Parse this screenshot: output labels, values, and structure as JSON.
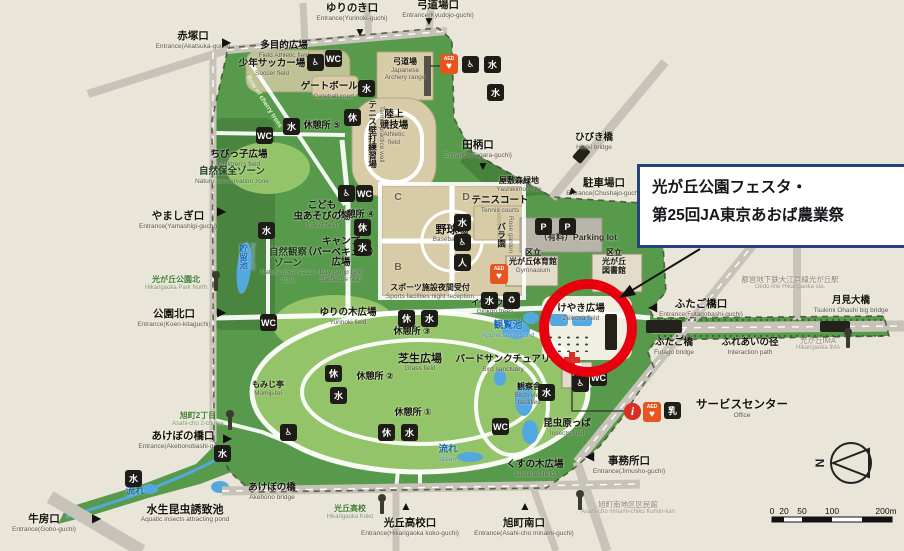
{
  "annotation": {
    "line1": "光が丘公園フェスタ・",
    "line2": "第25回JA東京あおば農業祭"
  },
  "compass": {
    "n": "N"
  },
  "scale": {
    "t0": "0",
    "t1": "20",
    "t2": "50",
    "t3": "100",
    "t4": "200m"
  },
  "colors": {
    "bg": "#eae5d9",
    "park": "#579a4b",
    "park_light": "#94c46a",
    "park_dark": "#47813c",
    "field": "#d8cca8",
    "road": "#c7c3b8",
    "water": "#54a8e0",
    "red": "#e8000f",
    "callout_border": "#26437e",
    "icon_bg": "#1d1c16",
    "aed": "#e8541e",
    "info": "#d93025"
  },
  "labels": [
    {
      "name": "entrance-akatsuka",
      "cls": "entrance",
      "x": 193,
      "y": 31,
      "jp": [
        "赤塚口"
      ],
      "en": [
        "Entrance(Akatsuka-guchi)"
      ]
    },
    {
      "name": "entrance-yurinoki",
      "cls": "entrance",
      "x": 352,
      "y": 3,
      "jp": [
        "ゆりのき口"
      ],
      "en": [
        "Entrance(Yurinoki-guchi)"
      ]
    },
    {
      "name": "entrance-kyudojo",
      "cls": "entrance",
      "x": 438,
      "y": 0,
      "jp": [
        "弓道場口"
      ],
      "en": [
        "Entrance(Kyudojo-guchi)"
      ]
    },
    {
      "name": "entrance-tagara",
      "cls": "entrance",
      "x": 478,
      "y": 140,
      "jp": [
        "田柄口"
      ],
      "en": [
        "Entrance(Tagara-guchi)"
      ]
    },
    {
      "name": "bridge-hibiki",
      "cls": "lbl",
      "x": 594,
      "y": 133,
      "jp": [
        "ひびき橋"
      ],
      "en": [
        "Hibiki bridge"
      ]
    },
    {
      "name": "entrance-chushajo",
      "cls": "entrance",
      "x": 604,
      "y": 178,
      "jp": [
        "駐車場口"
      ],
      "en": [
        "Entrance(Chushajo-guchi)"
      ]
    },
    {
      "name": "entrance-yamashigi",
      "cls": "entrance",
      "x": 178,
      "y": 211,
      "jp": [
        "やましぎ口"
      ],
      "en": [
        "Entrance(Yamashigi-guchi)"
      ]
    },
    {
      "name": "busstop-park-north",
      "cls": "bus",
      "x": 176,
      "y": 276,
      "jp": [
        "光が丘公園北"
      ],
      "en": [
        "Hikarigaoka Park North"
      ]
    },
    {
      "name": "entrance-koen-kita",
      "cls": "entrance",
      "x": 174,
      "y": 309,
      "jp": [
        "公園北口"
      ],
      "en": [
        "Entrance(Koen-kitaguchi)"
      ]
    },
    {
      "name": "station-oedo",
      "cls": "station",
      "x": 790,
      "y": 276,
      "jp": [
        "都営地下鉄大江戸線光が丘駅"
      ],
      "en": [
        "Oedo line Hikarigaoka sta."
      ]
    },
    {
      "name": "entrance-futagobashi",
      "cls": "entrance",
      "x": 701,
      "y": 299,
      "jp": [
        "ふたご橋口"
      ],
      "en": [
        "Entrance(Futagobashi-guchi)"
      ]
    },
    {
      "name": "bridge-tsukimi",
      "cls": "lbl",
      "x": 851,
      "y": 296,
      "jp": [
        "月見大橋"
      ],
      "en": [
        "Tsukimi Ohashi big bridge"
      ]
    },
    {
      "name": "bridge-futago",
      "cls": "lbl",
      "x": 674,
      "y": 338,
      "jp": [
        "ふたご橋"
      ],
      "en": [
        "Futago bridge"
      ]
    },
    {
      "name": "path-fureai",
      "cls": "lbl",
      "x": 750,
      "y": 338,
      "jp": [
        "ふれあいの径"
      ],
      "en": [
        "Interaction path"
      ]
    },
    {
      "name": "busstop-ima",
      "cls": "station",
      "x": 818,
      "y": 337,
      "jp": [
        "光が丘IMA"
      ],
      "en": [
        "Hikarigaoka IMA"
      ]
    },
    {
      "name": "service-center",
      "cls": "facility-lg",
      "x": 742,
      "y": 399,
      "jp": [
        "サービスセンター"
      ],
      "en": [
        "Office"
      ]
    },
    {
      "name": "entrance-jimusho",
      "cls": "entrance",
      "x": 629,
      "y": 456,
      "jp": [
        "事務所口"
      ],
      "en": [
        "Entrance(Jimusho-guchi)"
      ]
    },
    {
      "name": "busstop-asahicho-2",
      "cls": "bus",
      "x": 198,
      "y": 412,
      "jp": [
        "旭町2丁目"
      ],
      "en": [
        "Asahi-cho 2-chome"
      ]
    },
    {
      "name": "entrance-akebonobashi",
      "cls": "entrance",
      "x": 183,
      "y": 431,
      "jp": [
        "あけぼの橋口"
      ],
      "en": [
        "Entrance(Akebonobashi-guchi)"
      ]
    },
    {
      "name": "bridge-akebono",
      "cls": "lbl",
      "x": 272,
      "y": 483,
      "jp": [
        "あけぼの橋"
      ],
      "en": [
        "Akebono bridge"
      ]
    },
    {
      "name": "pond-suisei",
      "cls": "area-bold",
      "x": 185,
      "y": 504,
      "jp": [
        "水生昆虫誘致池"
      ],
      "en": [
        "Aquatic insects attracting pond"
      ]
    },
    {
      "name": "entrance-gobo",
      "cls": "entrance",
      "x": 44,
      "y": 514,
      "jp": [
        "牛房口"
      ],
      "en": [
        "Entrance(Gobo-guchi)"
      ]
    },
    {
      "name": "busstop-koko",
      "cls": "bus",
      "x": 350,
      "y": 505,
      "jp": [
        "光丘高校"
      ],
      "en": [
        "Hikarigaoka Koko"
      ]
    },
    {
      "name": "entrance-koko",
      "cls": "entrance",
      "x": 410,
      "y": 518,
      "jp": [
        "光丘高校口"
      ],
      "en": [
        "Entrance(Hikarigaoka koko-guchi)"
      ]
    },
    {
      "name": "entrance-asahicho-minami",
      "cls": "entrance",
      "x": 524,
      "y": 518,
      "jp": [
        "旭町南口"
      ],
      "en": [
        "Entrance(Asahi-cho minami-guchi)"
      ]
    },
    {
      "name": "busstop-kuminkan",
      "cls": "station",
      "x": 628,
      "y": 501,
      "jp": [
        "旭町南地区区民館"
      ],
      "en": [
        "Asahi-cho minami-chiku Kumin-kan"
      ]
    },
    {
      "name": "area-tamokuteki",
      "cls": "lbl",
      "x": 284,
      "y": 41,
      "jp": [
        "多目的広場"
      ],
      "en": [
        "Field Athletic field"
      ]
    },
    {
      "name": "area-soccer",
      "cls": "lbl",
      "x": 272,
      "y": 59,
      "jp": [
        "少年サッカー場"
      ],
      "en": [
        "Soccer field"
      ]
    },
    {
      "name": "area-gateball",
      "cls": "lbl",
      "x": 334,
      "y": 82,
      "jp": [
        "ゲートボール場"
      ],
      "en": [
        "Gateball court"
      ]
    },
    {
      "name": "area-kyudo",
      "cls": "facility-sm",
      "x": 405,
      "y": 58,
      "jp": [
        "弓道場"
      ],
      "en": [
        "Japanese",
        "Archery range"
      ]
    },
    {
      "name": "area-rikujo",
      "cls": "lbl",
      "x": 394,
      "y": 110,
      "jp": [
        "陸上",
        "競技場"
      ],
      "en": [
        "Athletic",
        "field"
      ]
    },
    {
      "name": "rest-5",
      "cls": "rest",
      "x": 322,
      "y": 120,
      "jp": [
        "休憩所 ⑤"
      ]
    },
    {
      "name": "area-chibikko",
      "cls": "lbl",
      "x": 239,
      "y": 150,
      "jp": [
        "ちびっ子広場"
      ],
      "en": [
        "Children's field"
      ]
    },
    {
      "name": "zone-hozen",
      "cls": "zone",
      "x": 232,
      "y": 167,
      "jp": [
        "自然保全ゾーン"
      ],
      "en": [
        "Nature conservation zone"
      ]
    },
    {
      "name": "area-mushi",
      "cls": "lbl",
      "x": 322,
      "y": 201,
      "jp": [
        "こども",
        "虫あそびの場"
      ],
      "en": [
        "Insect field"
      ]
    },
    {
      "name": "area-camp",
      "cls": "lbl",
      "x": 341,
      "y": 237,
      "jp": [
        "キャンプ",
        "（バーベキュー）",
        "広場"
      ],
      "en": [
        "Day camp field",
        "Barbecue field"
      ]
    },
    {
      "name": "zone-kansatsu",
      "cls": "zone",
      "x": 288,
      "y": 248,
      "jp": [
        "自然観察",
        "ゾーン"
      ],
      "en": [
        "Nature observation",
        "zone"
      ]
    },
    {
      "name": "pond-reservoir",
      "cls": "v blue",
      "x": 247,
      "y": 243,
      "jp": [
        "貯留池"
      ],
      "en": [
        "Reservoir"
      ]
    },
    {
      "name": "rest-4",
      "cls": "rest",
      "x": 356,
      "y": 209,
      "jp": [
        "休憩所 ④"
      ]
    },
    {
      "name": "area-yakyujo",
      "cls": "area-bold",
      "x": 452,
      "y": 224,
      "jp": [
        "野球場"
      ],
      "en": [
        "Baseball field"
      ]
    },
    {
      "name": "quad-c",
      "cls": "quad",
      "x": 398,
      "y": 192,
      "jp": [
        "C"
      ]
    },
    {
      "name": "quad-d",
      "cls": "quad",
      "x": 466,
      "y": 192,
      "jp": [
        "D"
      ]
    },
    {
      "name": "quad-b",
      "cls": "quad",
      "x": 398,
      "y": 262,
      "jp": [
        "B"
      ]
    },
    {
      "name": "quad-a",
      "cls": "quad",
      "x": 466,
      "y": 262,
      "jp": [
        "A"
      ]
    },
    {
      "name": "area-tennis",
      "cls": "lbl",
      "x": 500,
      "y": 196,
      "jp": [
        "テニスコート"
      ],
      "en": [
        "Tennis courts"
      ]
    },
    {
      "name": "area-yashikimori",
      "cls": "facility-sm",
      "x": 519,
      "y": 177,
      "jp": [
        "屋敷森緑地"
      ],
      "en": [
        "Yashikimori site"
      ]
    },
    {
      "name": "label-parking",
      "cls": "parking",
      "x": 578,
      "y": 233,
      "jp": [
        "（有料）Parking lot"
      ]
    },
    {
      "name": "facility-gym",
      "cls": "facility",
      "x": 533,
      "y": 249,
      "jp": [
        "区立",
        "光が丘体育館"
      ],
      "en": [
        "Gymnasium"
      ]
    },
    {
      "name": "facility-library",
      "cls": "facility",
      "x": 614,
      "y": 249,
      "jp": [
        "区立",
        "光が丘",
        "図書館"
      ]
    },
    {
      "name": "facility-sports-reception",
      "cls": "facility-sm",
      "x": 430,
      "y": 284,
      "jp": [
        "スポーツ施設夜間受付"
      ],
      "en": [
        "Sports facilities night reception"
      ]
    },
    {
      "name": "area-ginkgo",
      "cls": "facility-sm",
      "x": 495,
      "y": 299,
      "jp": [
        "イチョウ並木"
      ],
      "en": [
        "Ginkgo trees"
      ]
    },
    {
      "name": "pond-kanran",
      "cls": "blue",
      "x": 508,
      "y": 321,
      "jp": [
        "観覧池"
      ],
      "en": [
        "Appreciation pond"
      ]
    },
    {
      "name": "area-yurinoki-field",
      "cls": "lbl",
      "x": 348,
      "y": 308,
      "jp": [
        "ゆりの木広場"
      ],
      "en": [
        "Yurinoki field"
      ]
    },
    {
      "name": "rest-3",
      "cls": "rest",
      "x": 412,
      "y": 326,
      "jp": [
        "休憩所 ③"
      ]
    },
    {
      "name": "area-shibafu",
      "cls": "area-bold",
      "x": 420,
      "y": 353,
      "jp": [
        "芝生広場"
      ],
      "en": [
        "Grass field"
      ]
    },
    {
      "name": "rest-2",
      "cls": "rest",
      "x": 375,
      "y": 371,
      "jp": [
        "休憩所 ②"
      ]
    },
    {
      "name": "area-momiji",
      "cls": "facility-sm",
      "x": 268,
      "y": 381,
      "jp": [
        "もみじ亭"
      ],
      "en": [
        "Momiji-tei"
      ]
    },
    {
      "name": "rest-1",
      "cls": "rest",
      "x": 413,
      "y": 407,
      "jp": [
        "休憩所 ①"
      ]
    },
    {
      "name": "area-bird-sanctuary",
      "cls": "lbl",
      "x": 503,
      "y": 355,
      "jp": [
        "バードサンクチュアリ"
      ],
      "en": [
        "Bird sanctuary"
      ]
    },
    {
      "name": "facility-kansatsusha",
      "cls": "facility-sm",
      "x": 529,
      "y": 383,
      "jp": [
        "観察舎"
      ],
      "en": [
        "Birds view",
        "facilities"
      ]
    },
    {
      "name": "area-keyaki",
      "cls": "lbl",
      "x": 581,
      "y": 304,
      "jp": [
        "けやき広場"
      ],
      "en": [
        "Zelkova field"
      ]
    },
    {
      "name": "area-konchu",
      "cls": "lbl",
      "x": 567,
      "y": 419,
      "jp": [
        "昆虫原っぱ"
      ],
      "en": [
        "Insects field"
      ]
    },
    {
      "name": "area-kusunoki",
      "cls": "lbl",
      "x": 535,
      "y": 460,
      "jp": [
        "くすの木広場"
      ],
      "en": [
        "kusunoki field"
      ]
    },
    {
      "name": "stream-center",
      "cls": "blue",
      "x": 448,
      "y": 445,
      "jp": [
        "流れ"
      ],
      "en": [
        "stream"
      ]
    },
    {
      "name": "stream-west",
      "cls": "blue",
      "x": 135,
      "y": 487,
      "jp": [
        "流れ"
      ]
    },
    {
      "name": "area-tennis-wall",
      "cls": "v",
      "x": 376,
      "y": 100,
      "jp": [
        "テニス壁打練習場"
      ],
      "en": [
        "Tennis practice wall"
      ]
    },
    {
      "name": "area-rose-garden",
      "cls": "v",
      "x": 505,
      "y": 216,
      "jp": [
        "バラ園"
      ],
      "en": [
        "Rose garden"
      ]
    },
    {
      "name": "path-cherry",
      "cls": "diag",
      "x": 264,
      "y": 102,
      "en": [
        "Row of cherry trees"
      ]
    }
  ],
  "icons": [
    {
      "type": "sq",
      "name": "toilet-icon",
      "glyph": "WC",
      "x": 325,
      "y": 50
    },
    {
      "type": "sq",
      "name": "toilet-icon",
      "glyph": "WC",
      "x": 256,
      "y": 127
    },
    {
      "type": "sq",
      "name": "toilet-icon",
      "glyph": "WC",
      "x": 260,
      "y": 314
    },
    {
      "type": "sq",
      "name": "toilet-icon",
      "glyph": "WC",
      "x": 356,
      "y": 185
    },
    {
      "type": "sq",
      "name": "toilet-icon",
      "glyph": "WC",
      "x": 590,
      "y": 369
    },
    {
      "type": "sq",
      "name": "toilet-icon",
      "glyph": "WC",
      "x": 492,
      "y": 418
    },
    {
      "type": "sq",
      "name": "accessible-icon",
      "glyph": "♿",
      "x": 307,
      "y": 54
    },
    {
      "type": "sq",
      "name": "accessible-icon",
      "glyph": "♿",
      "x": 462,
      "y": 56
    },
    {
      "type": "sq",
      "name": "accessible-icon",
      "glyph": "♿",
      "x": 338,
      "y": 185
    },
    {
      "type": "sq",
      "name": "accessible-icon",
      "glyph": "♿",
      "x": 454,
      "y": 234
    },
    {
      "type": "sq",
      "name": "accessible-icon",
      "glyph": "♿",
      "x": 572,
      "y": 375
    },
    {
      "type": "sq",
      "name": "accessible-icon",
      "glyph": "♿",
      "x": 280,
      "y": 424
    },
    {
      "type": "sq",
      "name": "fountain-icon",
      "glyph": "水",
      "x": 484,
      "y": 56
    },
    {
      "type": "sq",
      "name": "fountain-icon",
      "glyph": "水",
      "x": 487,
      "y": 84
    },
    {
      "type": "sq",
      "name": "fountain-icon",
      "glyph": "水",
      "x": 358,
      "y": 80
    },
    {
      "type": "sq",
      "name": "fountain-icon",
      "glyph": "水",
      "x": 283,
      "y": 118
    },
    {
      "type": "sq",
      "name": "fountain-icon",
      "glyph": "水",
      "x": 258,
      "y": 222
    },
    {
      "type": "sq",
      "name": "fountain-icon",
      "glyph": "水",
      "x": 354,
      "y": 239
    },
    {
      "type": "sq",
      "name": "fountain-icon",
      "glyph": "水",
      "x": 454,
      "y": 214
    },
    {
      "type": "sq",
      "name": "fountain-icon",
      "glyph": "水",
      "x": 481,
      "y": 292
    },
    {
      "type": "sq",
      "name": "fountain-icon",
      "glyph": "水",
      "x": 421,
      "y": 310
    },
    {
      "type": "sq",
      "name": "fountain-icon",
      "glyph": "水",
      "x": 330,
      "y": 387
    },
    {
      "type": "sq",
      "name": "fountain-icon",
      "glyph": "水",
      "x": 401,
      "y": 424
    },
    {
      "type": "sq",
      "name": "fountain-icon",
      "glyph": "水",
      "x": 538,
      "y": 384
    },
    {
      "type": "sq",
      "name": "fountain-icon",
      "glyph": "水",
      "x": 214,
      "y": 445
    },
    {
      "type": "sq",
      "name": "fountain-icon",
      "glyph": "水",
      "x": 125,
      "y": 470
    },
    {
      "type": "sq",
      "name": "rest-shelter-icon",
      "glyph": "休",
      "x": 344,
      "y": 109
    },
    {
      "type": "sq",
      "name": "rest-shelter-icon",
      "glyph": "休",
      "x": 354,
      "y": 219
    },
    {
      "type": "sq",
      "name": "rest-shelter-icon",
      "glyph": "休",
      "x": 398,
      "y": 310
    },
    {
      "type": "sq",
      "name": "rest-shelter-icon",
      "glyph": "休",
      "x": 325,
      "y": 365
    },
    {
      "type": "sq",
      "name": "rest-shelter-icon",
      "glyph": "休",
      "x": 378,
      "y": 424
    },
    {
      "type": "sq",
      "name": "attendant-icon",
      "glyph": "人",
      "x": 454,
      "y": 254
    },
    {
      "type": "sq",
      "name": "recycle-icon",
      "glyph": "♻",
      "x": 503,
      "y": 292
    },
    {
      "type": "sq",
      "name": "baby-care-icon",
      "glyph": "乳",
      "x": 664,
      "y": 402
    },
    {
      "type": "sq",
      "name": "parking-car-icon",
      "glyph": "P",
      "x": 535,
      "y": 218
    },
    {
      "type": "sq",
      "name": "parking-accessible-icon",
      "glyph": "P",
      "x": 559,
      "y": 218
    },
    {
      "type": "aed",
      "name": "aed-icon",
      "glyph": "♥",
      "label": "AED",
      "x": 440,
      "y": 54
    },
    {
      "type": "aed",
      "name": "aed-icon",
      "glyph": "♥",
      "label": "AED",
      "x": 490,
      "y": 264
    },
    {
      "type": "aed",
      "name": "aed-icon",
      "glyph": "♥",
      "label": "AED",
      "x": 643,
      "y": 402
    },
    {
      "type": "info",
      "name": "info-icon",
      "glyph": "i",
      "x": 624,
      "y": 403
    },
    {
      "type": "mk",
      "name": "entrance-marker",
      "glyph": "▶",
      "x": 222,
      "y": 36
    },
    {
      "type": "mk",
      "name": "entrance-marker",
      "glyph": "▼",
      "x": 354,
      "y": 26
    },
    {
      "type": "mk",
      "name": "entrance-marker",
      "glyph": "▼",
      "x": 423,
      "y": 15
    },
    {
      "type": "mk",
      "name": "entrance-marker",
      "glyph": "▼",
      "x": 477,
      "y": 160
    },
    {
      "type": "mk",
      "name": "entrance-marker",
      "glyph": "▼",
      "x": 566,
      "y": 186,
      "rot": 45
    },
    {
      "type": "mk",
      "name": "entrance-marker",
      "glyph": "▶",
      "x": 217,
      "y": 205
    },
    {
      "type": "mk",
      "name": "entrance-marker",
      "glyph": "▶",
      "x": 217,
      "y": 306
    },
    {
      "type": "mk",
      "name": "entrance-marker",
      "glyph": "◀",
      "x": 648,
      "y": 301
    },
    {
      "type": "mk",
      "name": "entrance-marker",
      "glyph": "▶",
      "x": 223,
      "y": 432
    },
    {
      "type": "mk",
      "name": "entrance-marker",
      "glyph": "▶",
      "x": 92,
      "y": 512
    },
    {
      "type": "mk",
      "name": "entrance-marker",
      "glyph": "▲",
      "x": 400,
      "y": 500
    },
    {
      "type": "mk",
      "name": "entrance-marker",
      "glyph": "▲",
      "x": 519,
      "y": 500
    },
    {
      "type": "mk",
      "name": "entrance-marker",
      "glyph": "◀",
      "x": 585,
      "y": 450
    },
    {
      "type": "pole",
      "name": "bus-stop-icon",
      "x": 228,
      "y": 416
    },
    {
      "type": "pole",
      "name": "bus-stop-icon",
      "x": 214,
      "y": 277
    },
    {
      "type": "pole",
      "name": "bus-stop-icon",
      "x": 380,
      "y": 500
    },
    {
      "type": "pole",
      "name": "bus-stop-icon",
      "x": 578,
      "y": 496
    },
    {
      "type": "pole",
      "name": "bus-stop-icon",
      "x": 846,
      "y": 334
    },
    {
      "type": "bar",
      "name": "signboard-icon",
      "x": 605,
      "y": 314,
      "w": 12,
      "h": 36
    },
    {
      "type": "dots",
      "name": "festival-stalls-dots",
      "x": 546,
      "y": 334,
      "w": 42,
      "h": 18
    }
  ]
}
